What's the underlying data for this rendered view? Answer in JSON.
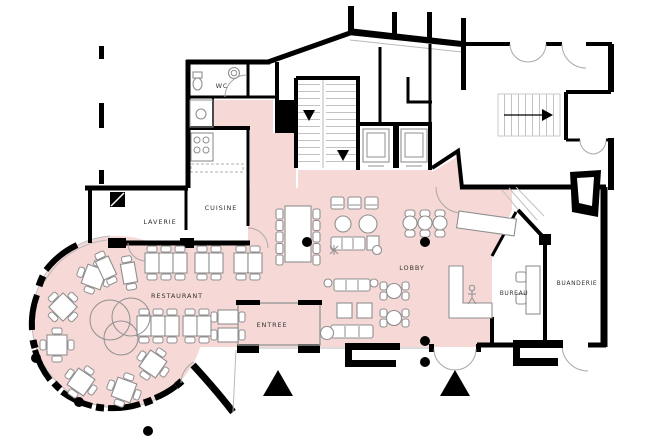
{
  "plan": {
    "type": "hotel-ground-floor-plan",
    "rooms": {
      "wc": "WC",
      "laverie": "LAVERIE",
      "cuisine": "CUISINE",
      "restaurant": "RESTAURANT",
      "entree": "ENTREE",
      "lobby": "LOBBY",
      "bureau": "BUREAU",
      "buanderie": "BUANDERIE"
    },
    "colors": {
      "zone_highlight": "#f6d8d6",
      "wall": "#000000",
      "furniture_line": "#8f8f8f",
      "label_text": "#333333",
      "paper": "#ffffff"
    }
  }
}
